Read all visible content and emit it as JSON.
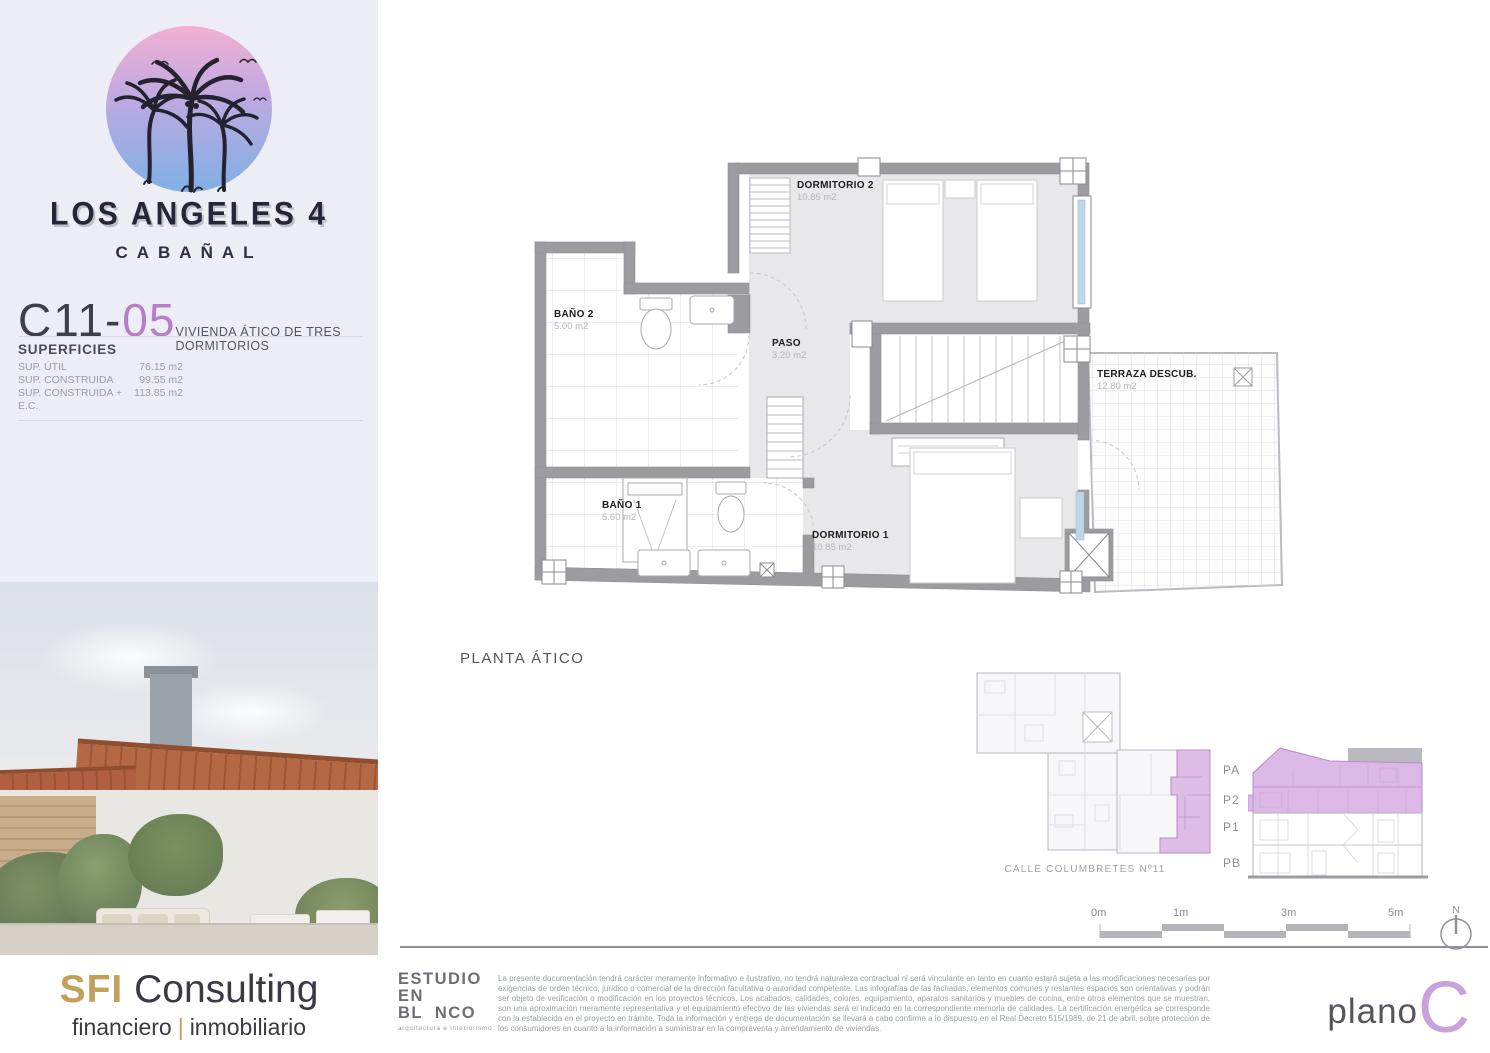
{
  "project": {
    "name": "LOS ANGELES 4",
    "location": "CABAÑAL",
    "unit_prefix": "C11-",
    "unit_number": "05",
    "unit_type": "VIVIENDA ÁTICO DE TRES DORMITORIOS"
  },
  "superficies": {
    "title": "SUPERFICIES",
    "rows": [
      {
        "label": "SUP. ÚTIL",
        "value": "76.15 m2"
      },
      {
        "label": "SUP. CONSTRUIDA",
        "value": "99.55 m2"
      },
      {
        "label": "SUP. CONSTRUIDA + E.C.",
        "value": "113.85 m2"
      }
    ]
  },
  "agency": {
    "brand_bold": "SFI",
    "brand_light": " Consulting",
    "tag_left": "financiero",
    "tag_sep": "|",
    "tag_right": "inmobiliario"
  },
  "plan": {
    "caption": "PLANTA ÁTICO",
    "rooms": {
      "dormitorio2": {
        "name": "DORMITORIO 2",
        "area": "10.85 m2"
      },
      "bano2": {
        "name": "BAÑO 2",
        "area": "5.00 m2"
      },
      "paso": {
        "name": "PASO",
        "area": "3.20 m2"
      },
      "bano1": {
        "name": "BAÑO 1",
        "area": "5.60 m2"
      },
      "dormitorio1": {
        "name": "DORMITORIO 1",
        "area": "10.85 m2"
      },
      "terraza": {
        "name": "TERRAZA DESCUB.",
        "area": "12.80 m2"
      }
    }
  },
  "keyplan": {
    "caption": "CALLE COLUMBRETES Nº11"
  },
  "section": {
    "floors": [
      "PA",
      "P2",
      "P1",
      "PB"
    ]
  },
  "scalebar": {
    "t0": "0m",
    "t1": "1m",
    "t3": "3m",
    "t5": "5m",
    "north": "N"
  },
  "studio": {
    "line1": "ESTUDIO",
    "line2": "EN",
    "line3": "BL  NCO",
    "subtitle": "arquitectura e interiorismo"
  },
  "legal_text": "La presente documentación tendrá carácter meramente informativo e ilustrativo, no tendrá naturaleza contractual ni será vinculante en tanto en cuanto estará sujeta a las modificaciones necesarias por exigencias de orden técnico, jurídico o comercial de la dirección facultativa o autoridad competente. Las infografías de las fachadas, elementos comunes y restantes espacios son orientativas y podrán ser objeto de verificación o modificación en los proyectos técnicos. Los acabados, calidades, colores, equipamiento, aparatos sanitarios y muebles de cocina, entre otros elementos que se muestran, son una aproximación meramente representativa y el equipamiento efectivo de las viviendas será el indicado en la correspondiente memoria de calidades. La certificación energética se corresponde con la establecida en el proyecto en trámite. Toda la información y entrega de documentación se llevará a cabo confirme a lo dispuesto en el Real Decreto 515/1989, de 21 de abril, sobre protección de los consumidores en cuanto a la información a suministrar en la compraventa y arrendamiento de viviendas.",
  "planologo": {
    "word": "plano",
    "letter": "C"
  },
  "colors": {
    "accent_purple": "#b57fc6",
    "logo_purple": "#c9a2dd",
    "highlight_lilac": "#d9b4e4",
    "gold": "#c2a05a",
    "wall_gray": "#9c9ca0",
    "panel_lavender": "#ededf5"
  }
}
